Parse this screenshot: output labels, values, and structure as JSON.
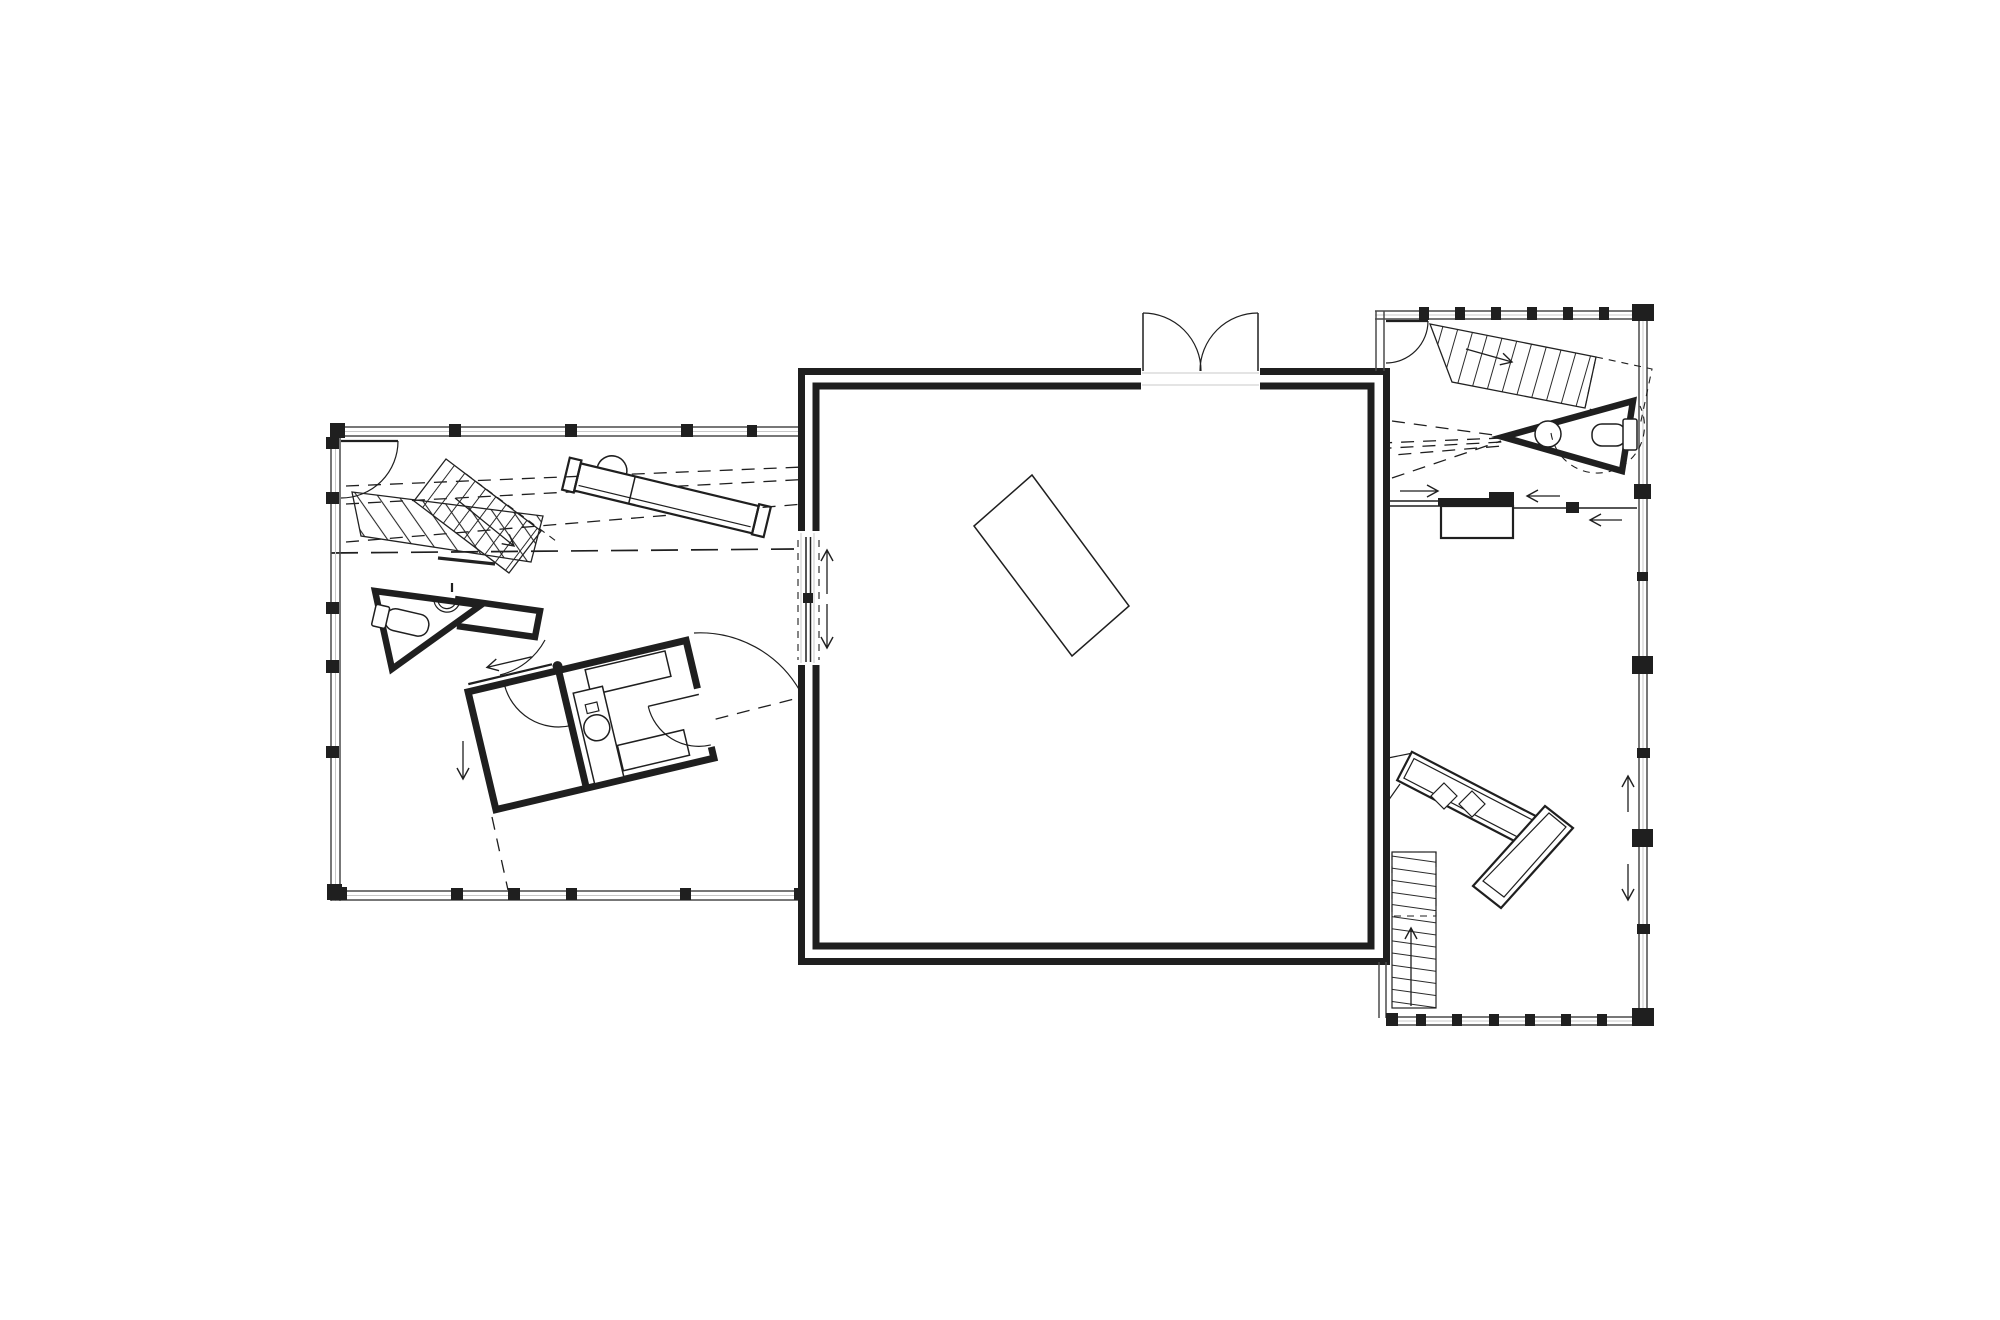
{
  "colors": {
    "paper": "#ffffff",
    "ink": "#1f1f1f",
    "wall_gray": "#4a4a4a",
    "light_gray": "#c8c8c8"
  },
  "drawing": {
    "icon_names": [
      "door-swing-icon",
      "double-door-icon",
      "sliding-door-arrow-icon",
      "stair-direction-arrow-icon",
      "toilet-icon",
      "washbasin-icon"
    ]
  }
}
